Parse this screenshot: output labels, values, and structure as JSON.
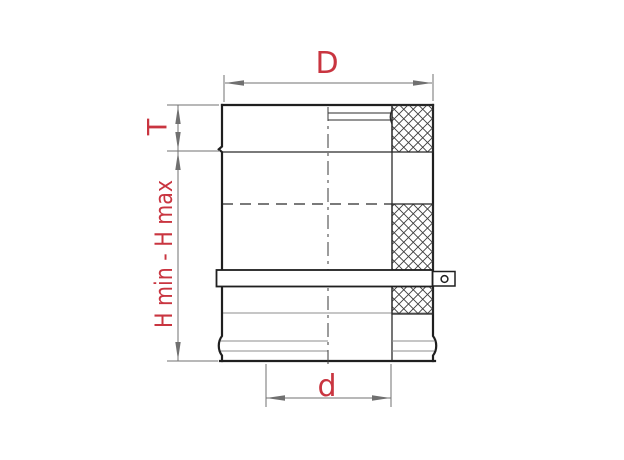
{
  "diagram": {
    "labels": {
      "outer_diameter": "D",
      "thickness": "T",
      "height_range": "H min - H max",
      "inner_diameter": "d"
    },
    "colors": {
      "label_red": "#c93540",
      "line_dark": "#1f1f1f",
      "line_gray": "#8c8c8c",
      "dimension_gray": "#707070",
      "background": "#ffffff"
    }
  }
}
